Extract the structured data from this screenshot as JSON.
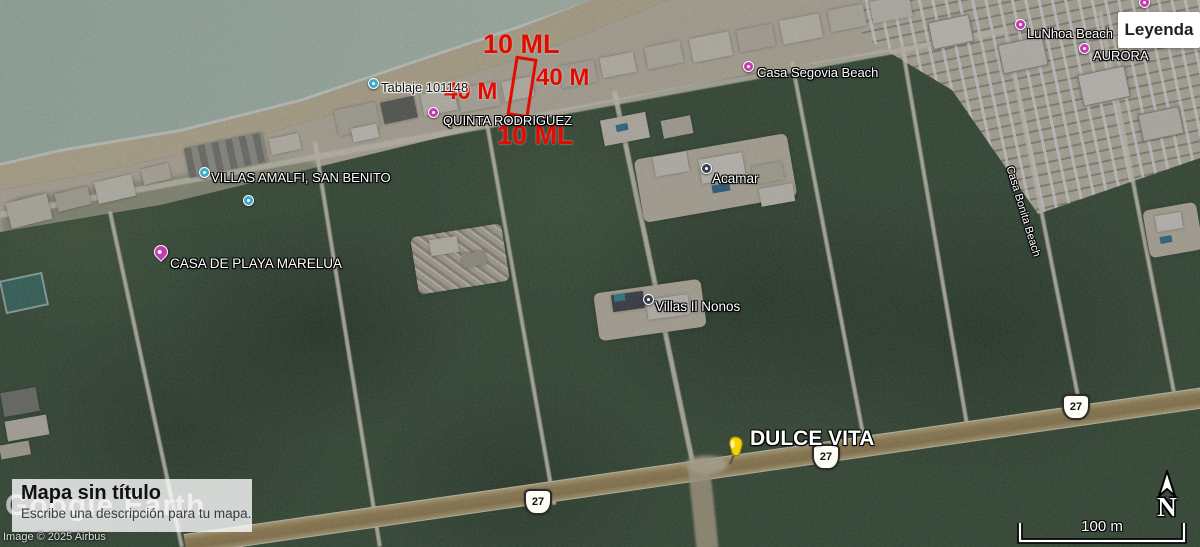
{
  "ui": {
    "legend_button_label": "Leyenda",
    "map_title": "Mapa sin título",
    "map_description": "Escribe una descripción para tu mapa.",
    "watermark_text": "Google Earth",
    "attribution": "Image © 2025 Airbus",
    "scale_label": "100 m",
    "north_label": "N"
  },
  "colors": {
    "annotation_red": "#e30b00",
    "pin_magenta": "#c73bb0",
    "pin_teal": "#3fa9c9",
    "pin_navy": "#35424f",
    "pushpin_yellow": "#f5d400",
    "vegetation": "#38523a",
    "ocean": "#c3dccf",
    "highway_sand": "#b2975f"
  },
  "measurements": {
    "items": [
      {
        "name": "measure-10ml-top",
        "text": "10 ML",
        "x": 483,
        "y": 31,
        "size": 27
      },
      {
        "name": "measure-40m-left",
        "text": "40 M",
        "x": 444,
        "y": 80,
        "size": 24
      },
      {
        "name": "measure-40m-right",
        "text": "40 M",
        "x": 536,
        "y": 66,
        "size": 24
      },
      {
        "name": "measure-10ml-bottom",
        "text": "10 ML",
        "x": 497,
        "y": 122,
        "size": 27
      }
    ],
    "rect": {
      "x": 511,
      "y": 57,
      "w": 16,
      "h": 54,
      "rotate": 9
    }
  },
  "map_labels": [
    {
      "name": "placemark-tablaje",
      "text": "Tablaje 101148",
      "tx": 381,
      "ty": 81,
      "size": 13,
      "style": "black",
      "pin": {
        "type": "circle",
        "color": "#3fa9c9",
        "x": 368,
        "y": 78
      },
      "interactable": true
    },
    {
      "name": "placemark-quinta-rodriguez",
      "text": "QUINTA RODRIGUEZ",
      "tx": 443,
      "ty": 114,
      "size": 13,
      "style": "white",
      "pin": {
        "type": "circle",
        "color": "#c73bb0",
        "x": 428,
        "y": 107
      },
      "interactable": true
    },
    {
      "name": "placemark-villas-amalfi",
      "text": "VILLAS AMALFI, SAN BENITO",
      "tx": 211,
      "ty": 171,
      "size": 13,
      "style": "white",
      "pin": {
        "type": "circle",
        "color": "#3fa9c9",
        "x": 199,
        "y": 167
      },
      "interactable": true
    },
    {
      "name": "placemark-unlabeled-teal",
      "tx": 0,
      "ty": 0,
      "size": 0,
      "style": "white",
      "pin": {
        "type": "circle",
        "color": "#3fa9c9",
        "x": 243,
        "y": 195
      },
      "interactable": true
    },
    {
      "name": "placemark-casa-marelua",
      "text": "CASA DE PLAYA MARELUA",
      "tx": 170,
      "ty": 257,
      "size": 13.5,
      "style": "white",
      "pin": {
        "type": "drop",
        "color": "#c73bb0",
        "x": 154,
        "y": 245
      },
      "interactable": true
    },
    {
      "name": "placemark-casa-segovia",
      "text": "Casa Segovia Beach",
      "tx": 757,
      "ty": 66,
      "size": 13,
      "style": "white",
      "pin": {
        "type": "circle",
        "color": "#c73bb0",
        "x": 743,
        "y": 61
      },
      "interactable": true
    },
    {
      "name": "placemark-lunhoa-beach",
      "text": "LuNhoa Beach",
      "tx": 1027,
      "ty": 27,
      "size": 13,
      "style": "white",
      "pin": {
        "type": "circle",
        "color": "#c73bb0",
        "x": 1015,
        "y": 19
      },
      "interactable": true
    },
    {
      "name": "placemark-aurora",
      "text": "AURORA",
      "tx": 1093,
      "ty": 49,
      "size": 13,
      "style": "white",
      "pin": {
        "type": "circle",
        "color": "#c73bb0",
        "x": 1079,
        "y": 43
      },
      "interactable": true
    },
    {
      "name": "placemark-acamar",
      "text": "Acamar",
      "tx": 712,
      "ty": 172,
      "size": 13.5,
      "style": "white",
      "pin": {
        "type": "circle",
        "color": "#35424f",
        "x": 701,
        "y": 163
      },
      "interactable": true
    },
    {
      "name": "placemark-villas-il-nonos",
      "text": "Villas Il Nonos",
      "tx": 655,
      "ty": 300,
      "size": 13.5,
      "style": "white",
      "pin": {
        "type": "circle",
        "color": "#35424f",
        "x": 643,
        "y": 294
      },
      "interactable": true
    },
    {
      "name": "placemark-dulce-vita",
      "text": "DULCE VITA",
      "tx": 750,
      "ty": 428,
      "size": 21,
      "bold": true,
      "style": "white",
      "pin": {
        "type": "pushpin",
        "x": 722,
        "y": 436
      },
      "interactable": true
    },
    {
      "name": "placemark-edge-top-right",
      "tx": 0,
      "ty": 0,
      "size": 0,
      "style": "white",
      "pin": {
        "type": "circle",
        "color": "#c73bb0",
        "x": 1139,
        "y": -3
      },
      "interactable": true
    },
    {
      "name": "street-label-beach",
      "text": "Casa Bonita Beach",
      "tx": 1014,
      "ty": 165,
      "size": 11,
      "style": "white",
      "rotate": 73,
      "interactable": false
    }
  ],
  "road_shields": {
    "items": [
      {
        "text": "27",
        "x": 524,
        "y": 489
      },
      {
        "text": "27",
        "x": 812,
        "y": 444
      },
      {
        "text": "27",
        "x": 1062,
        "y": 394
      }
    ]
  }
}
